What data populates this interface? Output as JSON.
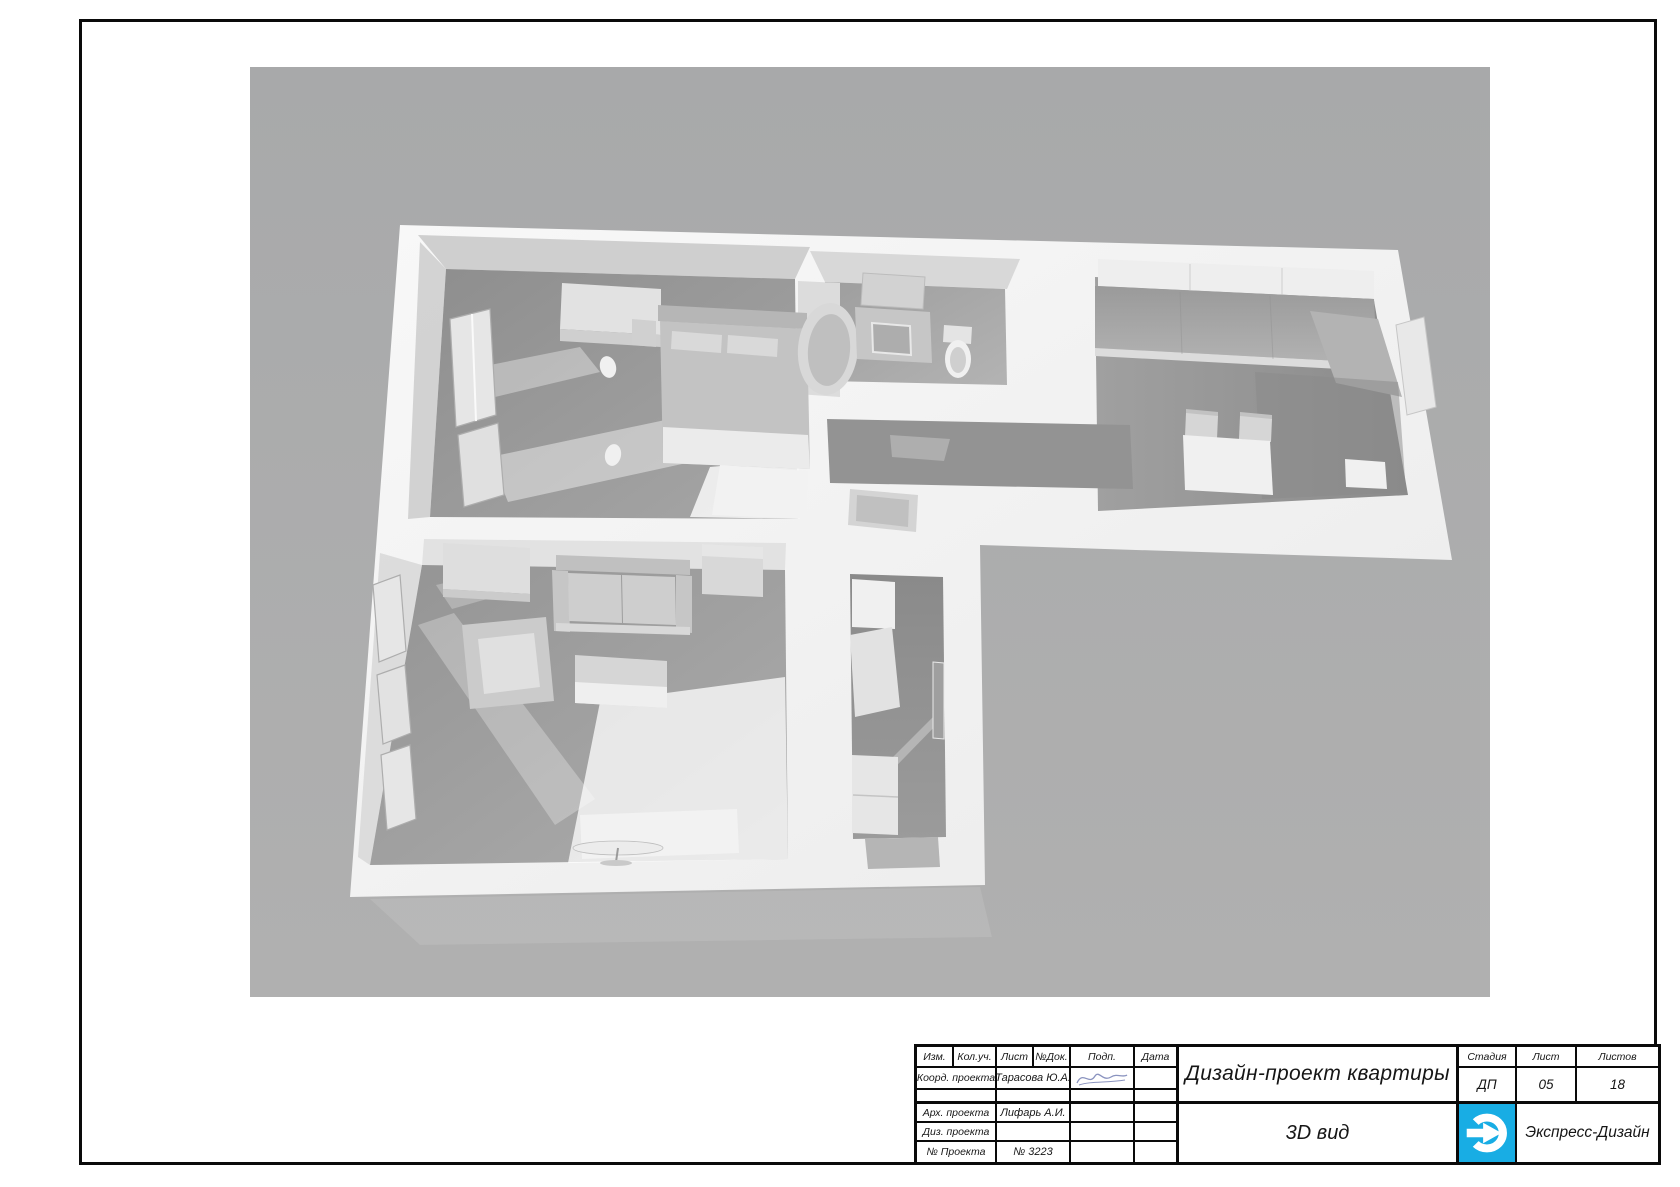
{
  "colors": {
    "canvas_background": "#aaabac",
    "logo_blue": "#18ade4"
  },
  "title_block": {
    "header": [
      "Изм.",
      "Кол.уч.",
      "Лист",
      "№Док.",
      "Подп.",
      "Дата"
    ],
    "rows": [
      {
        "label": "Коорд. проекта",
        "value": "Тарасова Ю.А."
      },
      {
        "label": "",
        "value": ""
      },
      {
        "label": "Арх. проекта",
        "value": "Лифарь А.И."
      },
      {
        "label": "Диз. проекта",
        "value": ""
      },
      {
        "label": "№ Проекта",
        "value": "№ 3223"
      }
    ],
    "project_title": "Дизайн-проект квартиры",
    "view_title": "3D вид",
    "stage": {
      "label": "Стадия",
      "value": "ДП"
    },
    "sheet": {
      "label": "Лист",
      "value": "05"
    },
    "sheets": {
      "label": "Листов",
      "value": "18"
    },
    "company": "Экспресс-Дизайн"
  }
}
